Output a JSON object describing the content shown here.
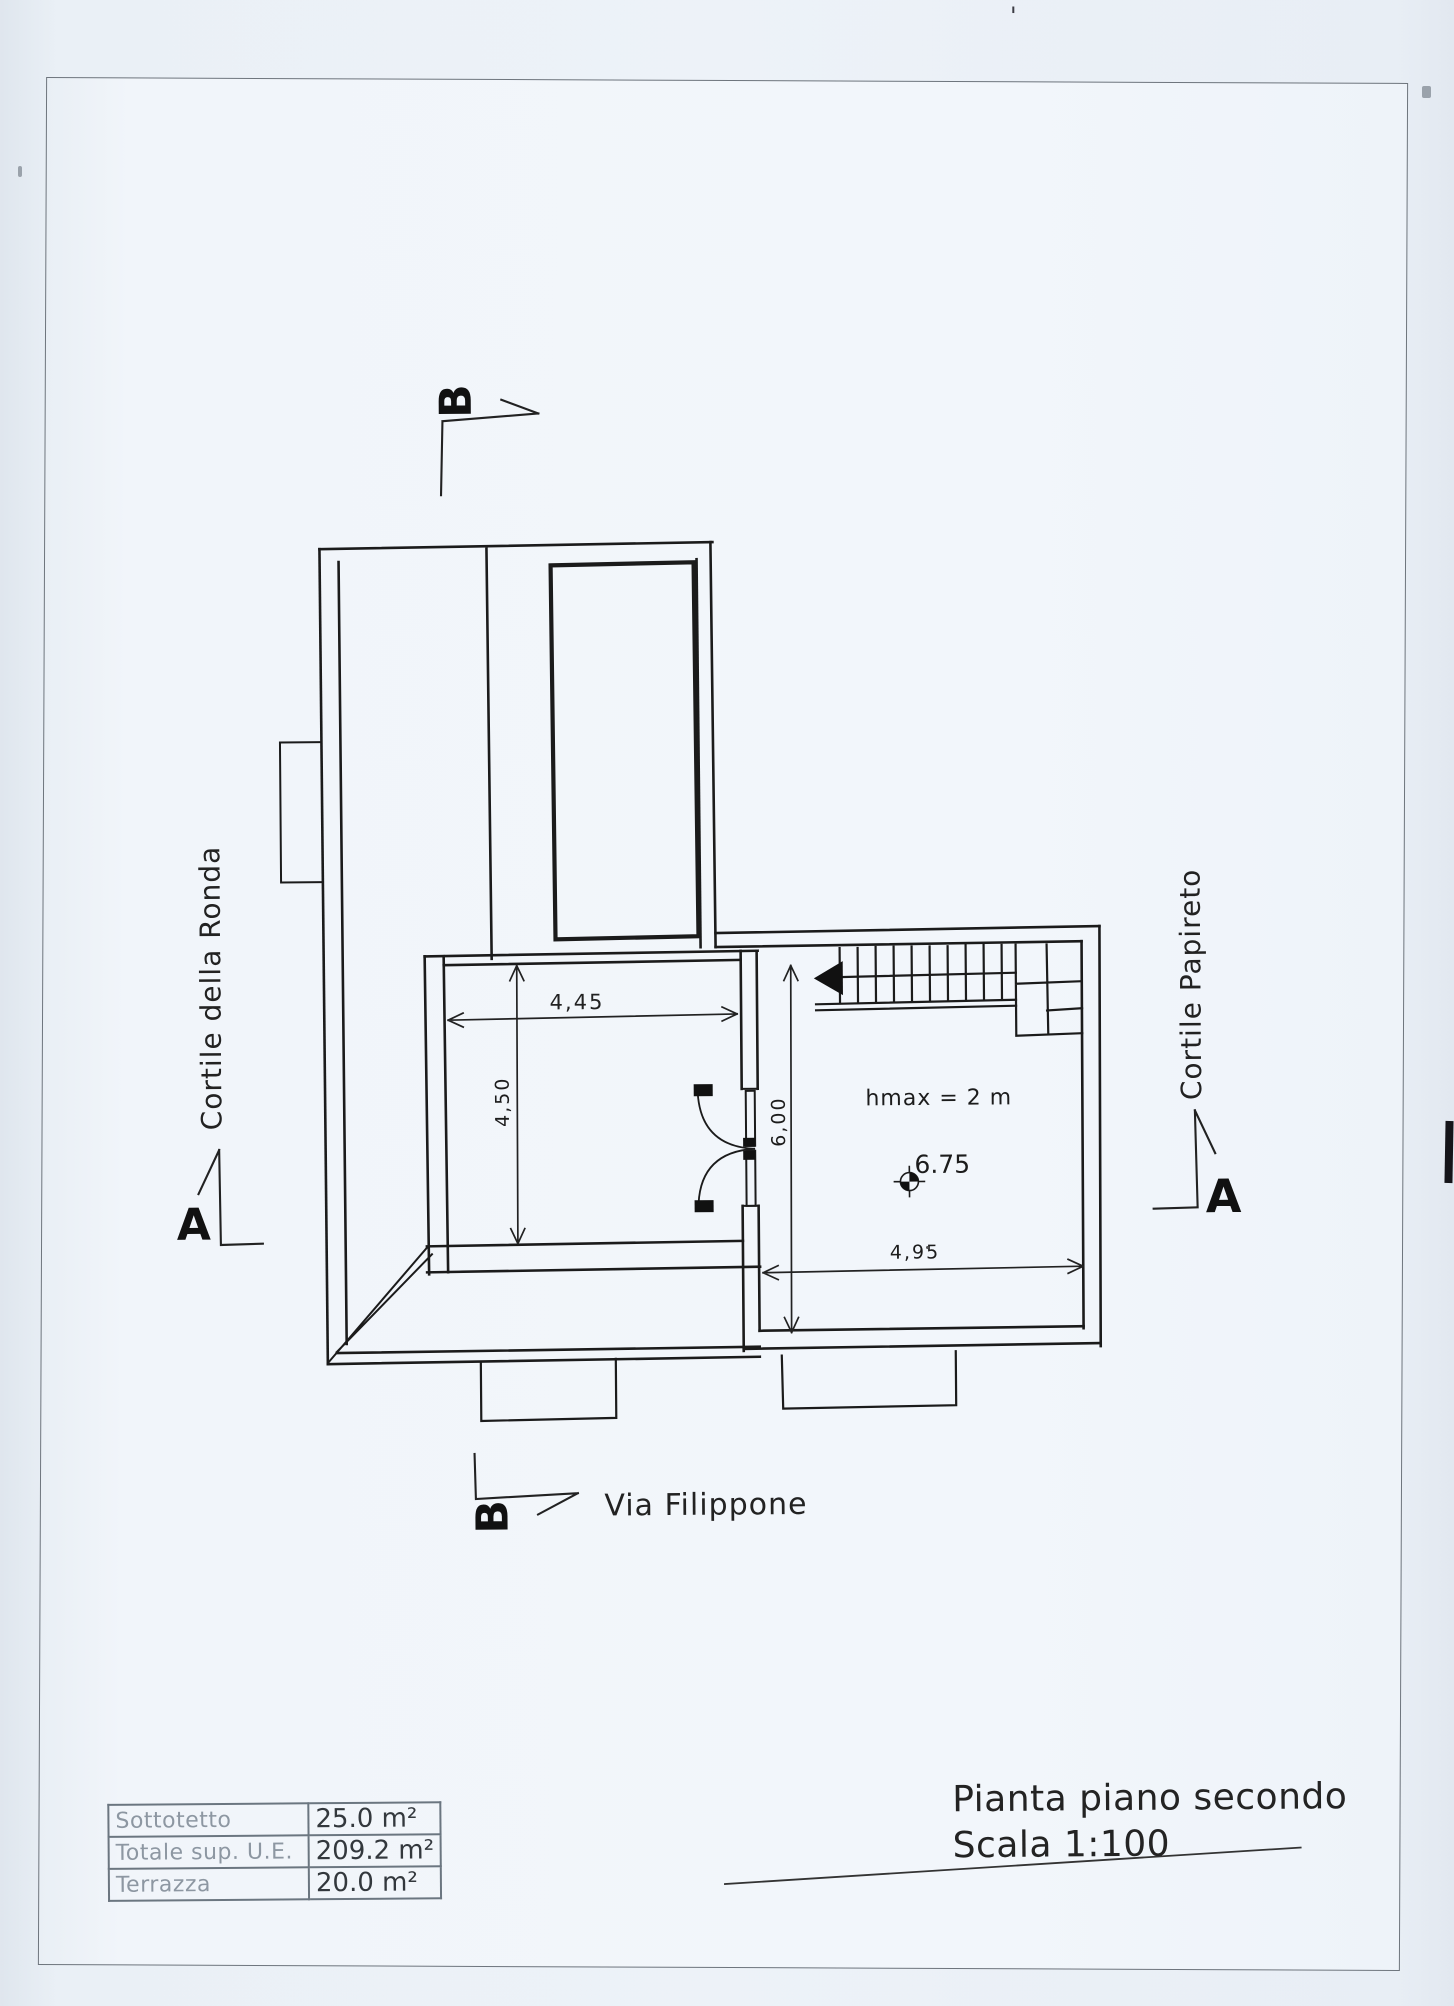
{
  "title": {
    "line1": "Pianta piano secondo",
    "line2": "Scala 1:100"
  },
  "street_labels": {
    "left": "Cortile della Ronda",
    "right": "Cortile Papireto",
    "bottom": "Via Filippone"
  },
  "section_markers": {
    "top": "B",
    "bottom": "B",
    "left": "A",
    "right": "A"
  },
  "dimensions": {
    "left_room_width": "4,45",
    "left_room_depth": "4,50",
    "right_room_depth": "6,00",
    "right_room_width": "4,95",
    "max_height_note": "hmax = 2 m",
    "spot_level": "6.75"
  },
  "area_table": {
    "rows": [
      {
        "label": "Sottotetto",
        "value": "25.0 m²"
      },
      {
        "label": "Totale sup. U.E.",
        "value": "209.2 m²"
      },
      {
        "label": "Terrazza",
        "value": "20.0 m²"
      }
    ]
  },
  "artifacts": {
    "apostrophe": "'"
  },
  "colors": {
    "paper": "#f1f5fa",
    "margin": "#e7edf3",
    "ink": "#1b1b1b",
    "faint_text": "#8d97a2",
    "table_line": "#6b7680"
  }
}
